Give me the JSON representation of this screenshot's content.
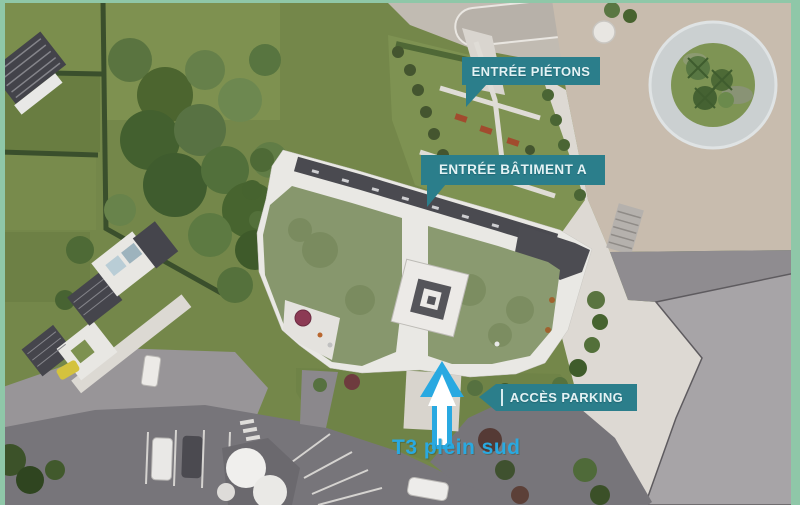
{
  "annotations": {
    "entree_pietons": {
      "label": "ENTRÉE PIÉTONS"
    },
    "entree_batiment_a": {
      "label": "ENTRÉE BÂTIMENT A"
    },
    "acces_parking": {
      "label": "ACCÈS PARKING"
    },
    "t3_plein_sud": {
      "label": "T3 plein sud"
    }
  },
  "icons": {
    "direction_arrow": "up-arrow",
    "parking_arrow": "left-arrow",
    "pietons_pointer": "down-pointer",
    "batiment_pointer": "down-pointer"
  },
  "colors": {
    "label_background": "#2b7e8b",
    "label_text": "#e3f2f4",
    "highlight_blue": "#29a9e1",
    "frame_border": "#8fc7a8"
  }
}
